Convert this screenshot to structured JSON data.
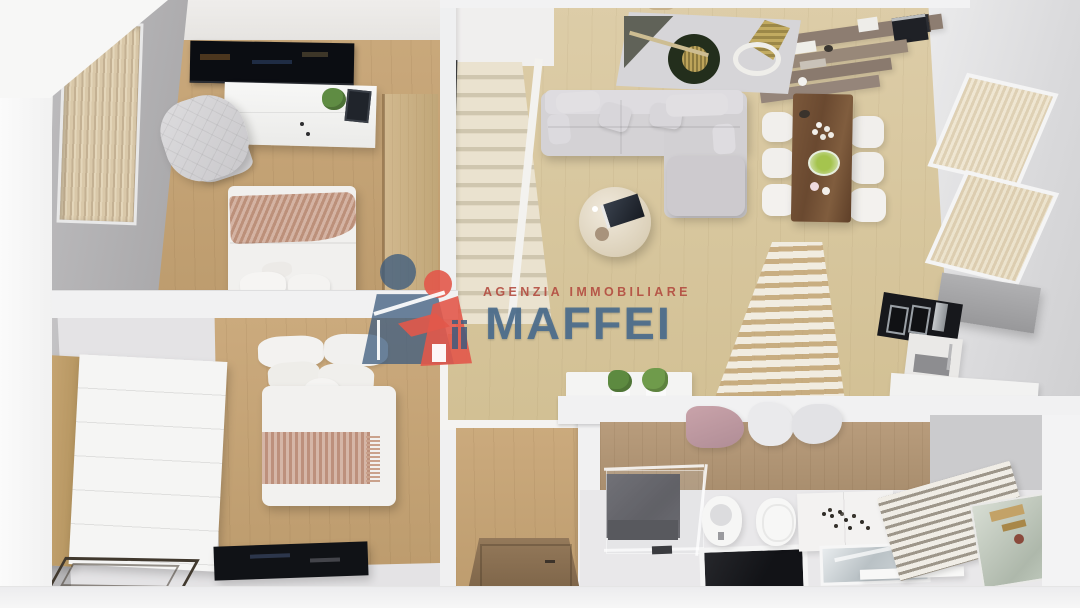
{
  "watermark": {
    "tagline": "AGENZIA IMMOBILIARE",
    "brand": "MAFFEI",
    "tagline_color": "rgba(178,72,60,0.88)",
    "brand_color": "rgba(75,109,140,0.92)",
    "logo_person_blue": "#3e5c7e",
    "logo_person_red": "#e2584a",
    "logo_house_color": "#ffffff"
  },
  "palette": {
    "outer_wall_white": "#f1f1f2",
    "interior_wall_gray": "#b3b2b4",
    "living_floor_wood": "#d6c49e",
    "bedroom_floor_wood": "#c5a477",
    "bathroom_wall_wood": "#ae9272",
    "sofa_gray": "#d3d1d4",
    "blanket_blush": "#c69a84",
    "dining_table_walnut": "#6a4930",
    "shelf_taupe": "#8d7d71",
    "kitchen_cabinet_gray": "#a4a4a6",
    "appliance_black": "#17181c",
    "blinds_beige": "#d9c8a9"
  },
  "scene": {
    "type": "3d-top-down-apartment-render",
    "rooms": [
      {
        "name": "bedroom-1",
        "furniture": [
          "wall-tv",
          "media-cabinet",
          "quilted-armchair",
          "double-bed",
          "window-blinds",
          "wood-door"
        ]
      },
      {
        "name": "bedroom-2",
        "furniture": [
          "wardrobe-dresser",
          "double-bed",
          "flat-tv",
          "glass-table-frame"
        ]
      },
      {
        "name": "living-room",
        "furniture": [
          "sectional-sofa",
          "round-coffee-table",
          "abstract-rug",
          "staircase"
        ]
      },
      {
        "name": "dining-area",
        "furniture": [
          "walnut-table",
          "white-chairs",
          "wall-shelves",
          "espresso-machine"
        ]
      },
      {
        "name": "kitchen",
        "furniture": [
          "gray-cabinets",
          "built-in-ovens",
          "white-counter",
          "slatted-partition"
        ]
      },
      {
        "name": "bathroom",
        "furniture": [
          "glass-shower",
          "bidet",
          "toilet",
          "vanity-cabinet",
          "sink-counter",
          "towel-radiator",
          "leaning-mirror",
          "hanging-towels"
        ]
      },
      {
        "name": "hallway",
        "furniture": [
          "entry-door",
          "half-wall-planters"
        ]
      }
    ]
  }
}
